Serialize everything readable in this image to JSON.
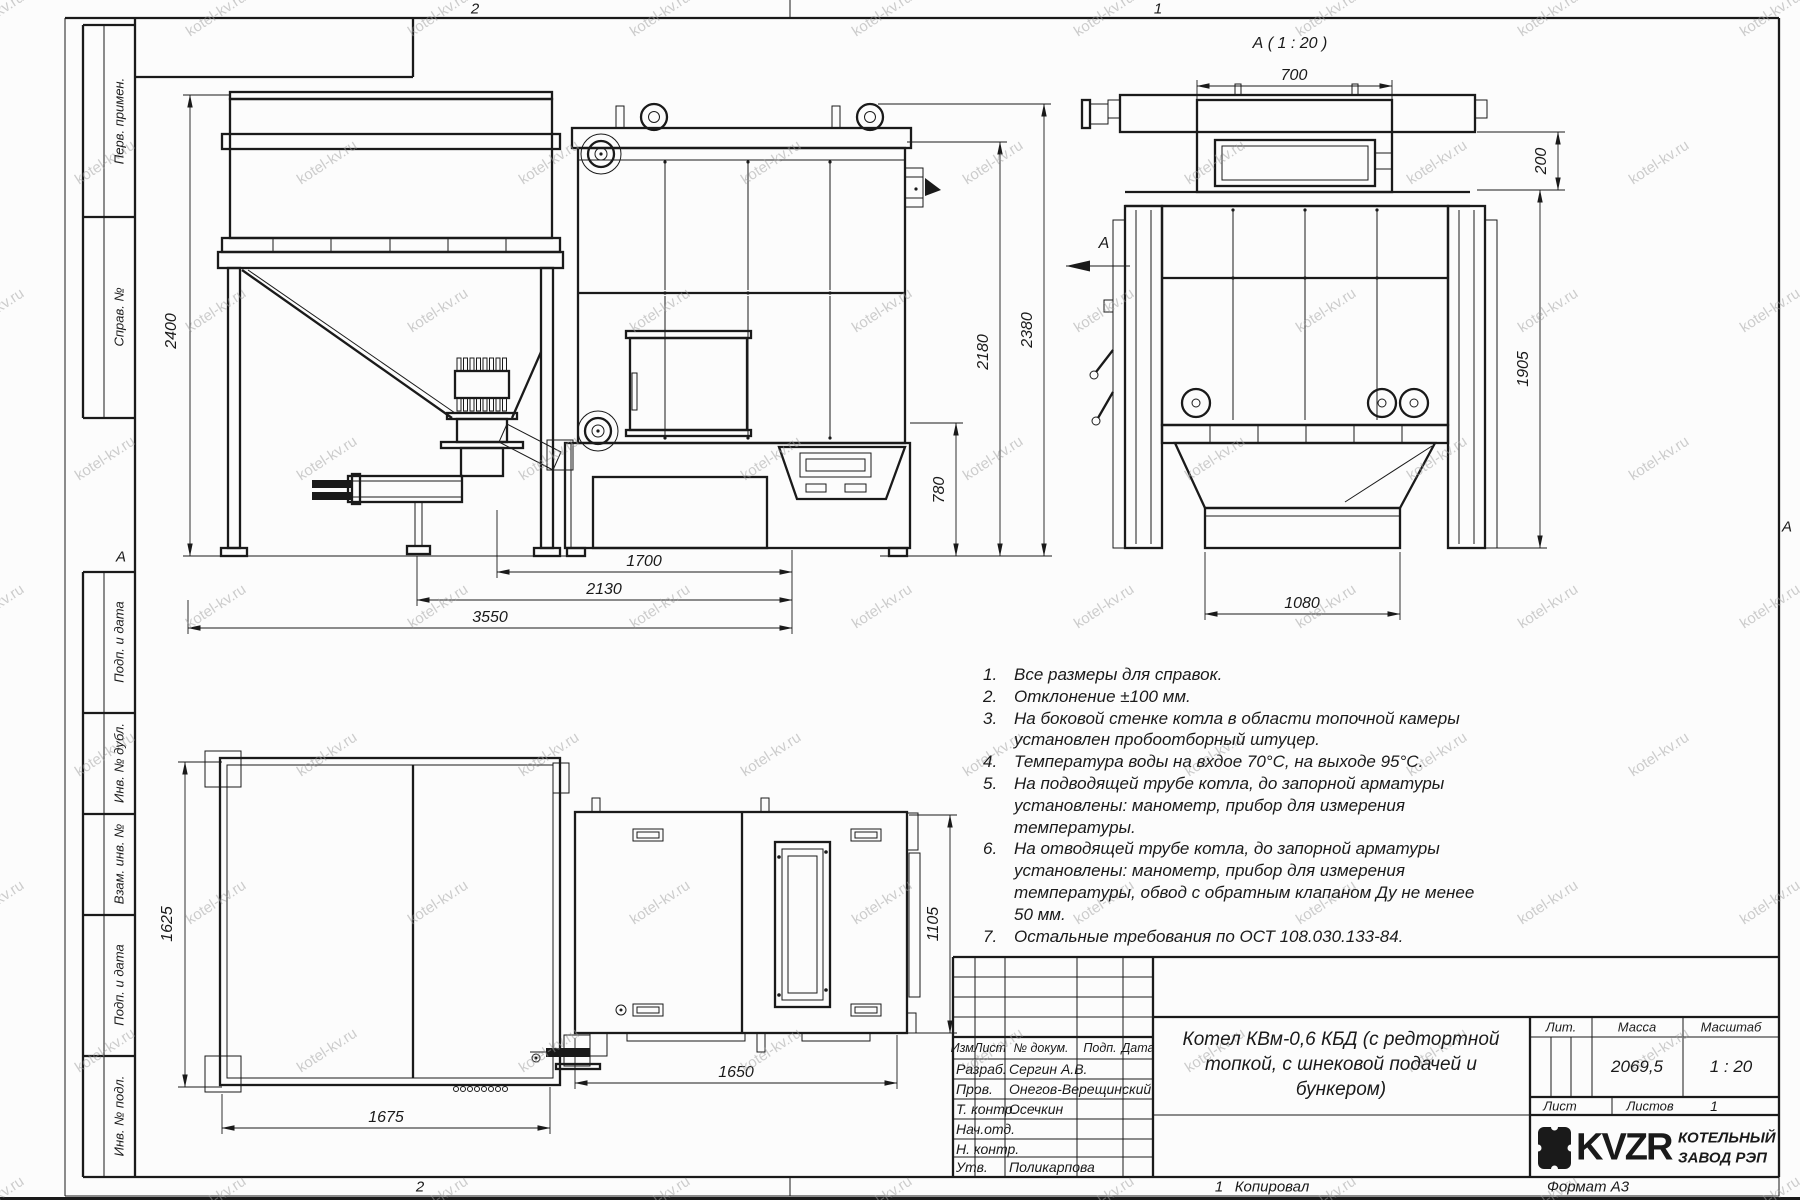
{
  "sheet": {
    "zone_top_left": "2",
    "zone_top_right": "1",
    "zone_bottom_left": "2",
    "zone_bottom_right": "1",
    "zone_letter": "А",
    "copied_label": "Копировал",
    "format_label": "Формат А3"
  },
  "watermark": {
    "text": "kotel-kv.ru"
  },
  "side_columns": {
    "perv_primen": "Перв. примен.",
    "sprav_no": "Справ. №",
    "podp_data_1": "Подп. и дата",
    "inv_dubl": "Инв. № дубл.",
    "vzam_inv": "Взам. инв. №",
    "podp_data_2": "Подп. и дата",
    "inv_podl": "Инв. № подл."
  },
  "views": {
    "detail_title": "А ( 1 : 20 )",
    "arrow_letter": "А"
  },
  "dims": {
    "d2400": "2400",
    "d3550": "3550",
    "d2130": "2130",
    "d1700": "1700",
    "d780": "780",
    "d2180": "2180",
    "d2380": "2380",
    "d700": "700",
    "d200": "200",
    "d1905": "1905",
    "d1080": "1080",
    "d1625": "1625",
    "d1675": "1675",
    "d1650": "1650",
    "d1105": "1105"
  },
  "notes": {
    "items": [
      {
        "num": "1.",
        "text": "Все размеры для справок."
      },
      {
        "num": "2.",
        "text": "Отклонение ±100 мм."
      },
      {
        "num": "3.",
        "text": "На боковой стенке котла в области топочной камеры установлен пробоотборный штуцер."
      },
      {
        "num": "4.",
        "text": "Температура воды на вхдое 70°С, на выходе 95°С."
      },
      {
        "num": "5.",
        "text": "На подводящей трубе котла, до запорной арматуры установлены: манометр, прибор для измерения температуры."
      },
      {
        "num": "6.",
        "text": "На отводящей трубе котла, до запорной арматуры установлены: манометр, прибор для измерения температуры, обвод с обратным клапаном Ду не менее 50 мм."
      },
      {
        "num": "7.",
        "text": "Остальные требования по ОСТ 108.030.133-84."
      }
    ]
  },
  "title_block": {
    "rev_header": {
      "izm": "Изм.",
      "list": "Лист",
      "doc": "№ докум.",
      "podp": "Подп.",
      "data": "Дата"
    },
    "rows": [
      {
        "role": "Разраб.",
        "name": "Сергин А.В."
      },
      {
        "role": "Пров.",
        "name": "Онегов-Верещинский"
      },
      {
        "role": "Т. контр.",
        "name": "Осечкин"
      },
      {
        "role": "Нач.отд.",
        "name": ""
      },
      {
        "role": "Н. контр.",
        "name": ""
      },
      {
        "role": "Утв.",
        "name": "Поликарпова"
      }
    ],
    "title_lines": [
      "Котел КВм-0,6 КБД (с редтортной",
      "топкой, с шнековой подачей и",
      "бункером)"
    ],
    "lit_label": "Лит.",
    "mass_label": "Масса",
    "scale_label": "Масштаб",
    "mass_value": "2069,5",
    "scale_value": "1 : 20",
    "sheet_label": "Лист",
    "sheets_label": "Листов",
    "sheets_value": "1",
    "company": {
      "logo_text": "KVZR",
      "name_line1": "КОТЕЛЬНЫЙ",
      "name_line2": "ЗАВОД РЭП"
    }
  }
}
